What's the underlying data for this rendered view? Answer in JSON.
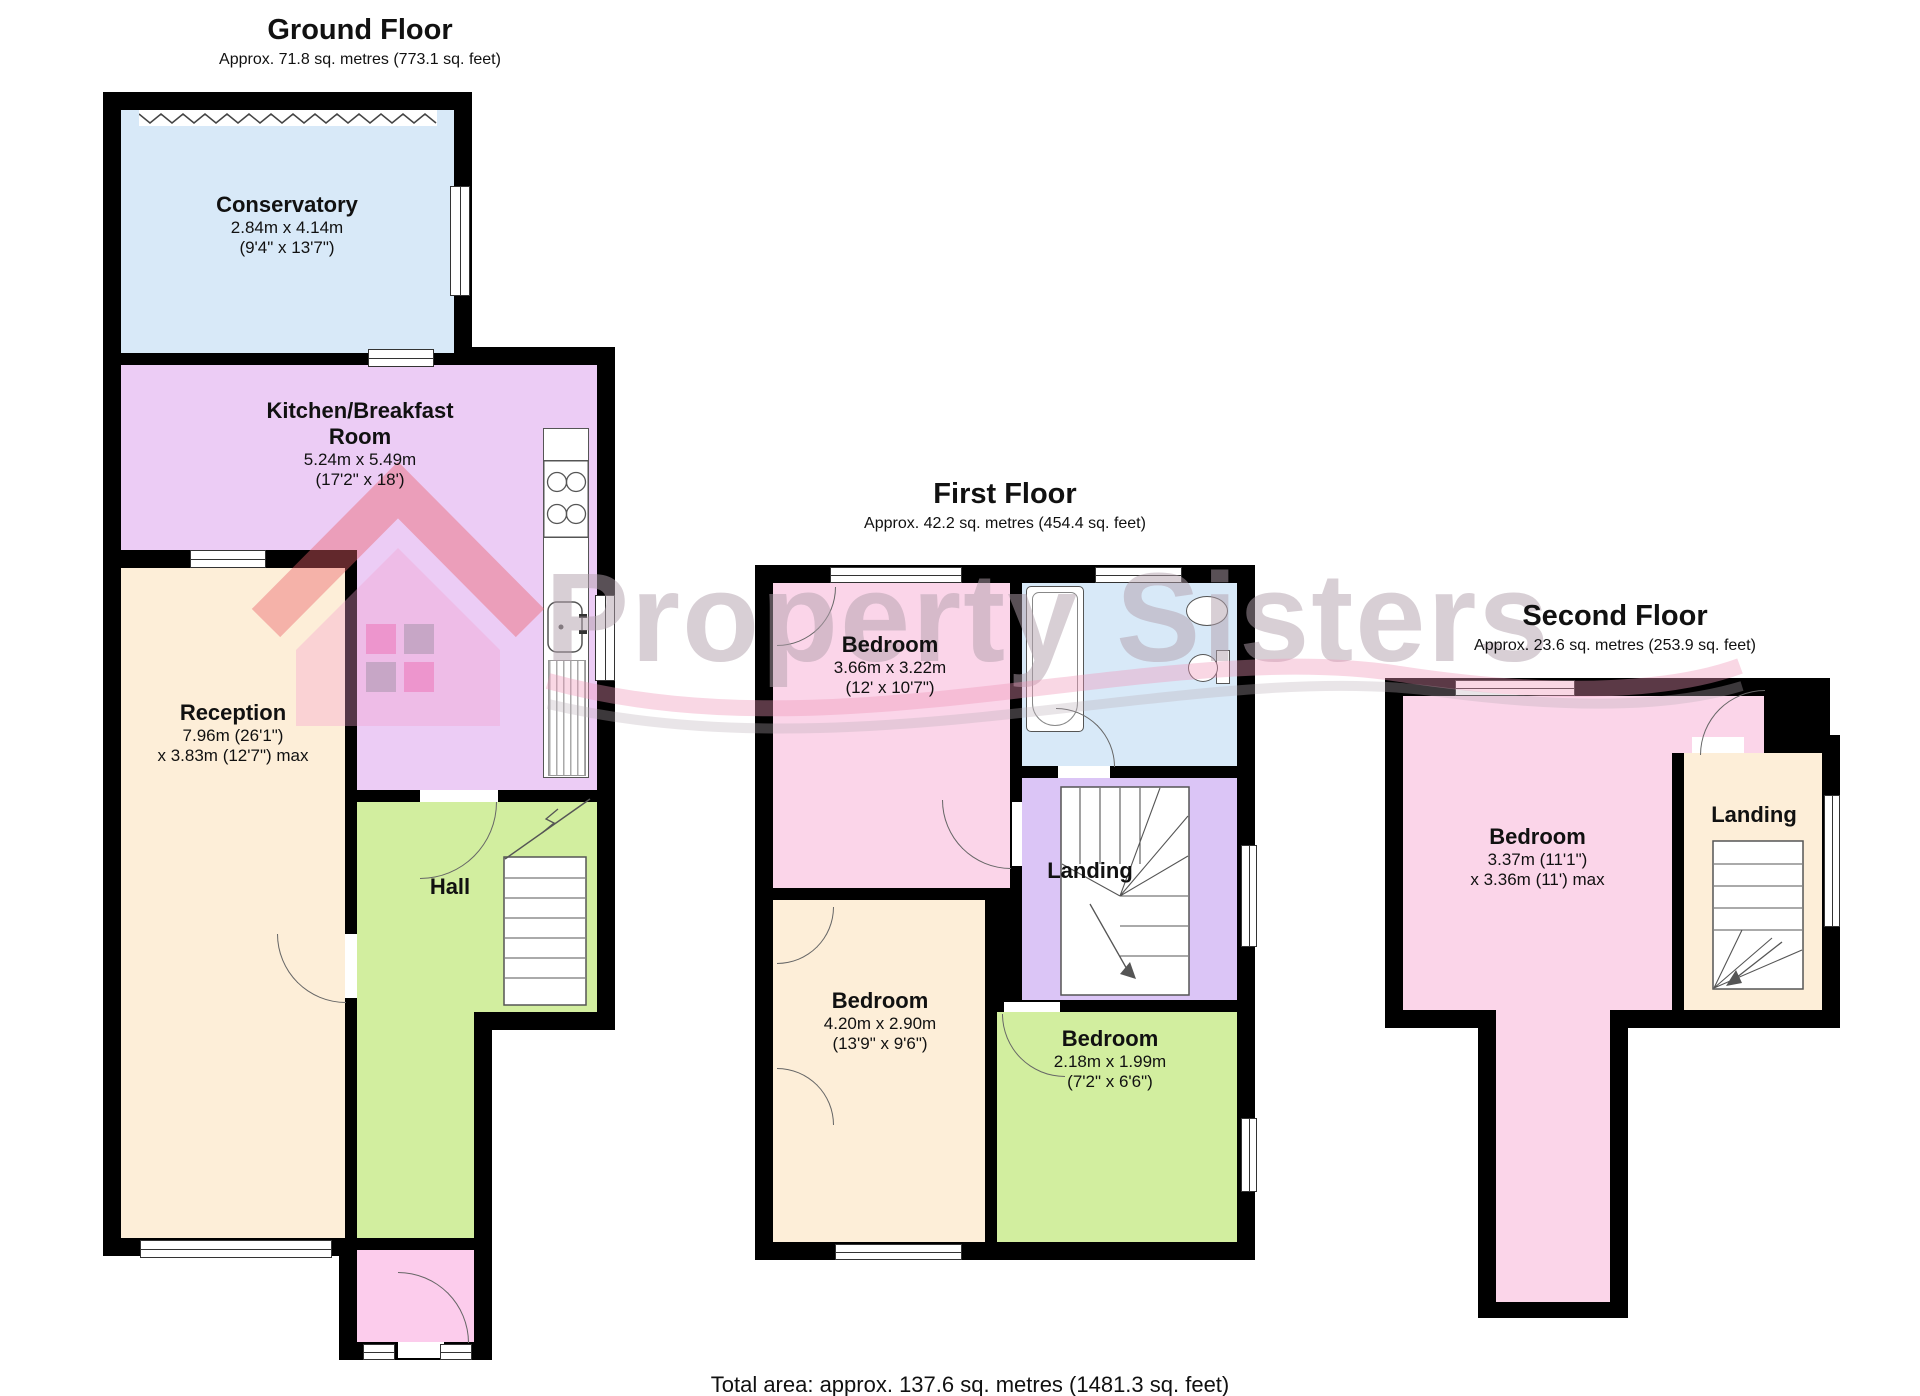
{
  "watermark": {
    "brand": "Property Sisters"
  },
  "total_area": "Total area: approx. 137.6 sq. metres (1481.3 sq. feet)",
  "colors": {
    "wall": "#000000",
    "conservatory_blue": "#d8e9f8",
    "kitchen_lilac": "#ecccf5",
    "reception_cream": "#fdeed8",
    "hall_green": "#d2ee9f",
    "porch_pink": "#fcccec",
    "bedroom_pink": "#fbd5e9",
    "landing_purple": "#dbc5f6",
    "watermark_grey": "#b1a0ac",
    "watermark_pink": "#ee96b7",
    "watermark_red": "#e95f69"
  },
  "floors": [
    {
      "title": "Ground Floor",
      "subtitle": "Approx. 71.8 sq. metres (773.1 sq. feet)",
      "rooms": [
        {
          "name": "Conservatory",
          "dims_metric": "2.84m x 4.14m",
          "dims_imperial": "(9'4\" x 13'7\")"
        },
        {
          "name": "Kitchen/Breakfast Room",
          "dims_metric": "5.24m x 5.49m",
          "dims_imperial": "(17'2\" x 18')"
        },
        {
          "name": "Reception",
          "dims_metric": "7.96m (26'1\")",
          "dims_imperial": "x 3.83m (12'7\") max"
        },
        {
          "name": "Hall"
        }
      ]
    },
    {
      "title": "First Floor",
      "subtitle": "Approx. 42.2 sq. metres (454.4 sq. feet)",
      "rooms": [
        {
          "name": "Bedroom",
          "dims_metric": "3.66m x 3.22m",
          "dims_imperial": "(12' x 10'7\")"
        },
        {
          "name": "Bedroom",
          "dims_metric": "4.20m x 2.90m",
          "dims_imperial": "(13'9\" x 9'6\")"
        },
        {
          "name": "Bedroom",
          "dims_metric": "2.18m x 1.99m",
          "dims_imperial": "(7'2\" x 6'6\")"
        },
        {
          "name": "Landing"
        }
      ]
    },
    {
      "title": "Second Floor",
      "subtitle": "Approx. 23.6 sq. metres (253.9 sq. feet)",
      "rooms": [
        {
          "name": "Bedroom",
          "dims_metric": "3.37m (11'1\")",
          "dims_imperial": "x 3.36m (11') max"
        },
        {
          "name": "Landing"
        }
      ]
    }
  ]
}
